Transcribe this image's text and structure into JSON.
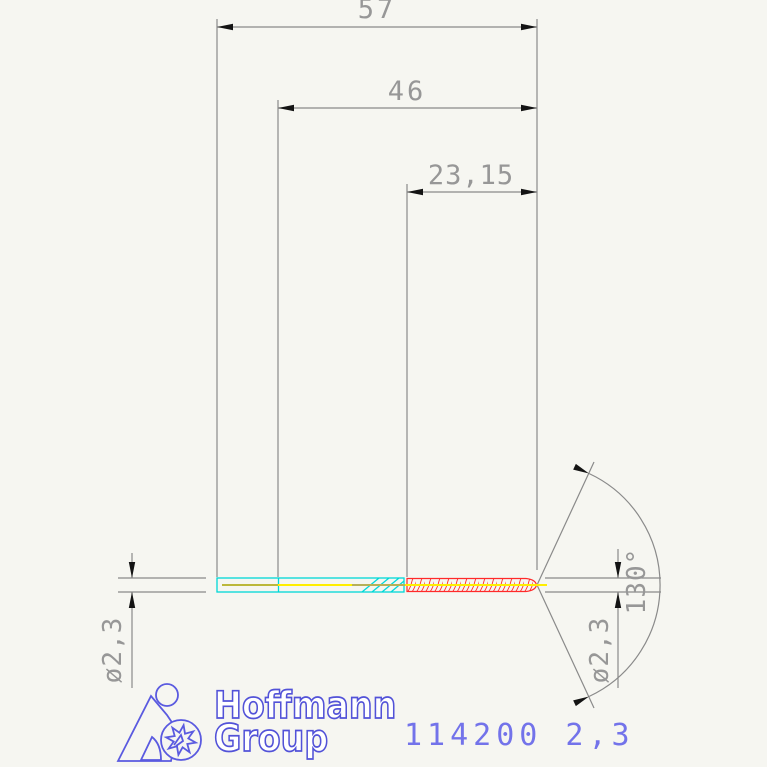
{
  "drawing": {
    "type": "technical-dimension-drawing",
    "subject": "twist drill side view",
    "dimensions": {
      "overall_length": "57",
      "length_to_neck": "46",
      "flute_length": "23,15",
      "shank_diameter": "ø2,3",
      "tip_diameter": "ø2,3",
      "point_angle": "130°"
    },
    "colors": {
      "background": "#f6f6f1",
      "dimension_line": "#8a8a8a",
      "dimension_text": "#979797",
      "arrow": "#141414",
      "shank_outline": "#00d8d8",
      "centerline_yellow": "#ffee00",
      "centerline_olive": "#a6a64f",
      "flute_red": "#ff2a2a",
      "brand_blue": "#5252d8",
      "part_number_blue": "#7373ea"
    }
  },
  "branding": {
    "name_line1": "Hoffmann",
    "name_line2": "Group",
    "icon": "hoffmann-figure-star-icon"
  },
  "part": {
    "number": "114200 2,3"
  }
}
